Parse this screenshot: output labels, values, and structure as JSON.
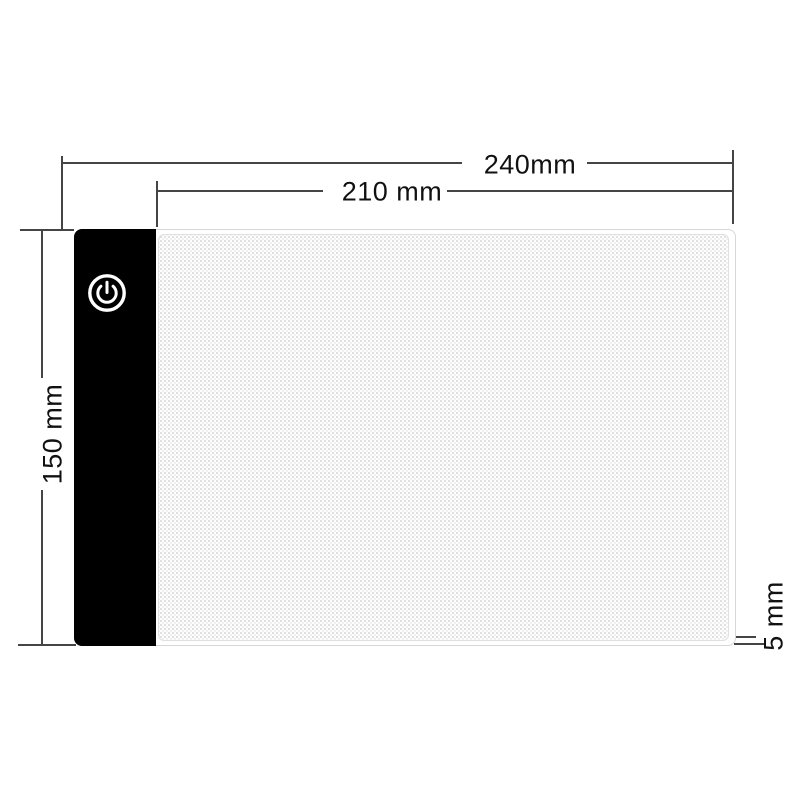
{
  "diagram": {
    "type": "product-dimension-diagram",
    "subject": "LED tracing light pad, top view with dimension callouts",
    "labels": {
      "overall_width": "240mm",
      "panel_width": "210 mm",
      "height": "150 mm",
      "thickness": "5 mm"
    },
    "icons": {
      "power": "power-icon"
    },
    "colors": {
      "background": "#ffffff",
      "device_frame": "#000000",
      "power_symbol": "#ffffff",
      "dimension_line": "#454545",
      "label_text": "#111111",
      "surface_dot": "#dadada",
      "surface_border": "#e0e0e0"
    }
  }
}
